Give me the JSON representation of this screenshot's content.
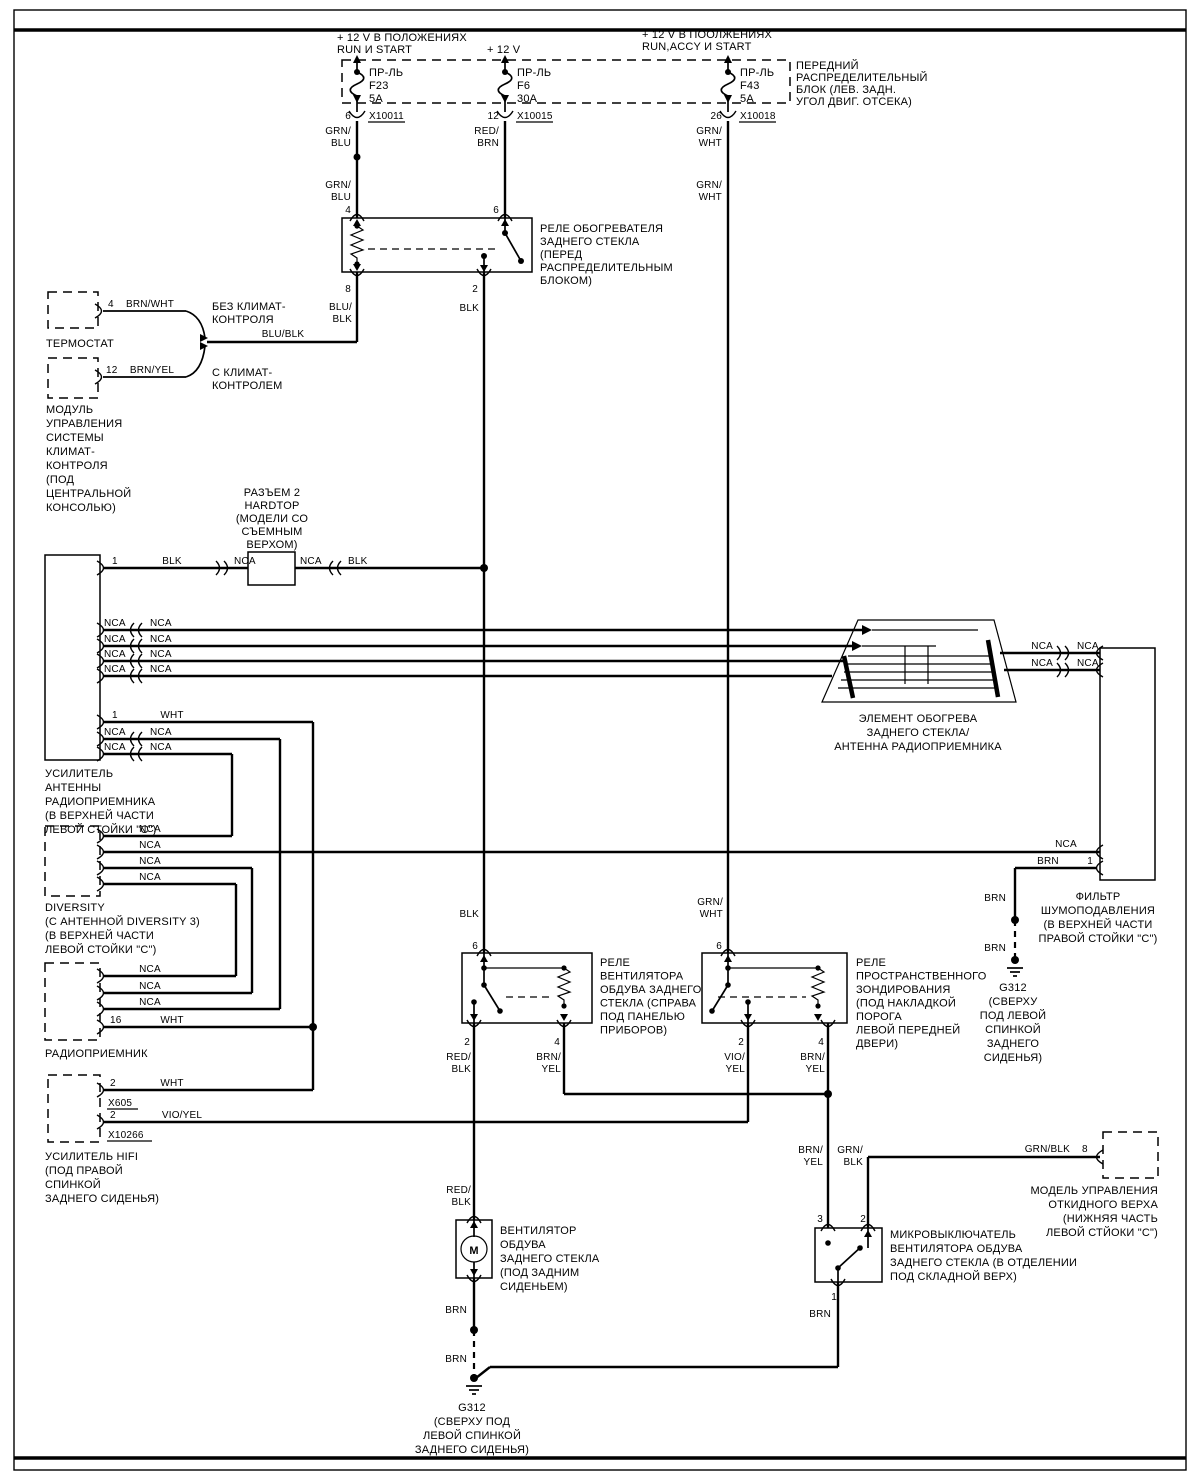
{
  "diagram": {
    "kind": "wiring-diagram",
    "language": "ru"
  },
  "colors": {
    "ink": "#000000",
    "paper": "#ffffff"
  },
  "w": {
    "nca": "NCA",
    "blk": "BLK",
    "wht": "WHT",
    "brn": "BRN",
    "grn_blu": "GRN/\nBLU",
    "red_brn": "RED/\nBRN",
    "grn_wht": "GRN/\nWHT",
    "blu_blk2": "BLU/\nBLK",
    "blu_blk": "BLU/BLK",
    "brn_wht": "BRN/WHT",
    "brn_yel": "BRN/YEL",
    "brn_yel2": "BRN/\nYEL",
    "red_blk2": "RED/\nBLK",
    "vio_yel": "VIO/YEL",
    "vio_yel2": "VIO/\nYEL",
    "grn_blk": "GRN/BLK",
    "grn_blk2": "GRN/\nBLK"
  },
  "power": {
    "feed1": "+  12 V  В ПОЛОЖЕНИЯХ\nRUN И   START",
    "feed2": "+  12 V",
    "feed3": "+  12 V  В ПООЛЖЕНИЯХ\nRUN,ACCY И START",
    "block_label": "ПЕРЕДНИЙ\nРАСПРЕДЕЛИТЕЛЬНЫЙ\nБЛОК (ЛЕВ. ЗАДН.\nУГОЛ ДВИГ. ОТСЕКА)",
    "fuse_word": "ПР-ЛЬ",
    "fuse1": {
      "name": "F23",
      "amp": "5A",
      "pin": "6",
      "conn": "X10011"
    },
    "fuse2": {
      "name": "F6",
      "amp": "30A",
      "pin": "12",
      "conn": "X10015"
    },
    "fuse3": {
      "name": "F43",
      "amp": "5A",
      "pin": "26",
      "conn": "X10018"
    }
  },
  "heater_relay": {
    "label": "РЕЛЕ ОБОГРЕВАТЕЛЯ\nЗАДНЕГО СТЕКЛА\n(ПЕРЕД\nРАСПРЕДЕЛИТЕЛЬНЫМ\nБЛОКОМ)",
    "pin4": "4",
    "pin6": "6",
    "pin8": "8",
    "pin2": "2"
  },
  "climate": {
    "thermostat_label": "ТЕРМОСТАТ",
    "thermostat_pin": "4",
    "thermostat_wire": "BRN/WHT",
    "module_label": "МОДУЛЬ\nУПРАВЛЕНИЯ\nСИСТЕМЫ\nКЛИМАТ-\nКОНТРОЛЯ\n(ПОД\nЦЕНТРАЛЬНОЙ\nКОНСОЛЬЮ)",
    "module_pin": "12",
    "module_wire": "BRN/YEL",
    "no_ac": "БЕЗ КЛИМАТ-\nКОНТРОЛЯ",
    "with_ac": "С КЛИМАТ-\nКОНТРОЛЕМ"
  },
  "razem2": {
    "label": "РАЗЪЕМ 2\nHARDTOP\n(МОДЕЛИ СО\nСЪЕМНЫМ\nВЕРХОМ)",
    "pin": "1"
  },
  "antenna_amp": {
    "label": "УСИЛИТЕЛЬ\nАНТЕННЫ\nРАДИОПРИЕМНИКА\n(В ВЕРХНЕЙ ЧАСТИ\nЛЕВОЙ СТОЙКИ \"С\")",
    "pin1": "1"
  },
  "diversity": {
    "label": "DIVERSITY\n(С АНТЕННОЙ DIVERSITY 3)\n(В ВЕРХНЕЙ ЧАСТИ\nЛЕВОЙ СТОЙКИ \"С\")"
  },
  "radio": {
    "label": "РАДИОПРИЕМНИК",
    "pin16": "16"
  },
  "hifi": {
    "label": "УСИЛИТЕЛЬ HIFI\n(ПОД ПРАВОЙ\nСПИНКОЙ\nЗАДНЕГО СИДЕНЬЯ)",
    "pin_a": "2",
    "conn_a": "X605",
    "pin_b": "2",
    "conn_b": "X10266"
  },
  "element": {
    "label": "ЭЛЕМЕНТ ОБОГРЕВА\nЗАДНЕГО СТЕКЛА/\nАНТЕННА РАДИОПРИЕМНИКА"
  },
  "filter": {
    "label": "ФИЛЬТР\nШУМОПОДАВЛЕНИЯ\n(В ВЕРХНЕЙ ЧАСТИ\nПРАВОЙ СТОЙКИ \"С\")",
    "pin1": "1"
  },
  "g312_right": {
    "label": "G312\n(СВЕРХУ\nПОД ЛЕВОЙ\nСПИНКОЙ\nЗАДНЕГО\nСИДЕНЬЯ)"
  },
  "fan_relay": {
    "label": "РЕЛЕ\nВЕНТИЛЯТОРА\nОБДУВА ЗАДНЕГО\nСТЕКЛА (СПРАВА\nПОД ПАНЕЛЬЮ\nПРИБОРОВ)",
    "pin6": "6",
    "pin2": "2",
    "pin4": "4"
  },
  "sounding_relay": {
    "label": "РЕЛЕ\nПРОСТРАНСТВЕННОГО\nЗОНДИРОВАНИЯ\n(ПОД НАКЛАДКОЙ\nПОРОГА\nЛЕВОЙ ПЕРЕДНЕЙ\nДВЕРИ)",
    "pin6": "6",
    "pin2": "2",
    "pin4": "4"
  },
  "fan_motor": {
    "label": "ВЕНТИЛЯТОР\nОБДУВА\nЗАДНЕГО СТЕКЛА\n(ПОД ЗАДНИМ\nСИДЕНЬЕМ)",
    "symbol": "M"
  },
  "microswitch": {
    "label": "МИКРОВЫКЛЮЧАТЕЛЬ\nВЕНТИЛЯТОРА ОБДУВА\nЗАДНЕГО СТЕКЛА (В ОТДЕЛЕНИИ\nПОД СКЛАДНОЙ ВЕРХ)",
    "pin3": "3",
    "pin2": "2",
    "pin1": "1"
  },
  "top_module": {
    "label": "МОДЕЛЬ УПРАВЛЕНИЯ\nОТКИДНОГО ВЕРХА\n(НИЖНЯЯ ЧАСТЬ\nЛЕВОЙ СТЙОКИ \"С\")",
    "pin8": "8",
    "wire": "GRN/BLK"
  },
  "g312_bottom": {
    "label": "G312\n(СВЕРХУ ПОД\nЛЕВОЙ СПИНКОЙ\nЗАДНЕГО СИДЕНЬЯ)"
  }
}
